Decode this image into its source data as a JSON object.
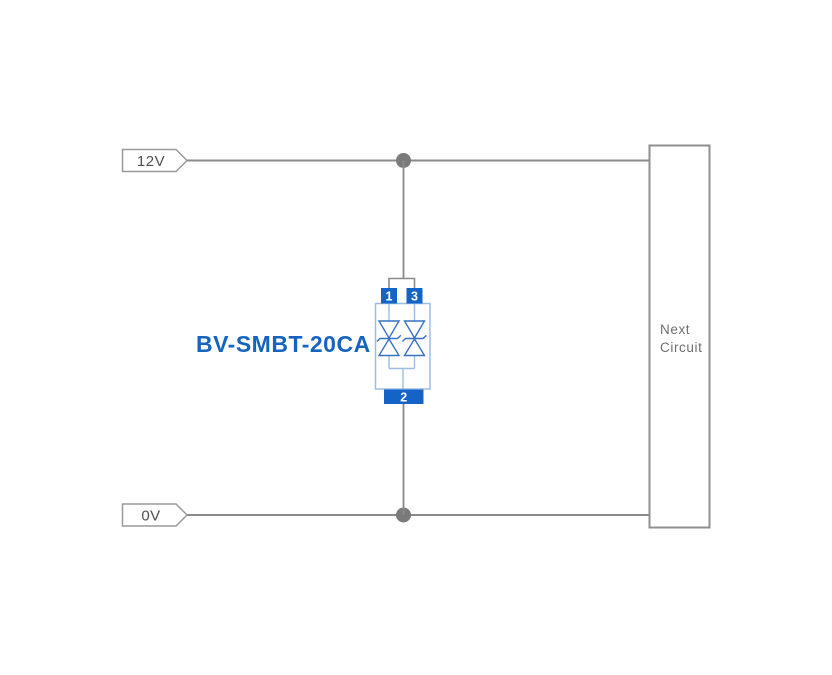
{
  "diagram": {
    "component_label": "BV-SMBT-20CA",
    "rails": {
      "top": "12V",
      "bottom": "0V"
    },
    "next_circuit": {
      "line1": "Next",
      "line2": "Circuit"
    },
    "tvs": {
      "pin1": "1",
      "pin3": "3",
      "pin2": "2"
    },
    "colors": {
      "wire": "#8a8a8a",
      "junction_dot": "#7a7a7a",
      "tag_border": "#9a9a9a",
      "tag_text": "#4f4f4f",
      "box_border": "#8f8f8f",
      "box_text": "#6e6e6e",
      "pin_blue": "#1464c8",
      "body_outline_blue": "#9dbde4",
      "diode_blue": "#3572c6",
      "label_blue": "#1565c0"
    }
  }
}
